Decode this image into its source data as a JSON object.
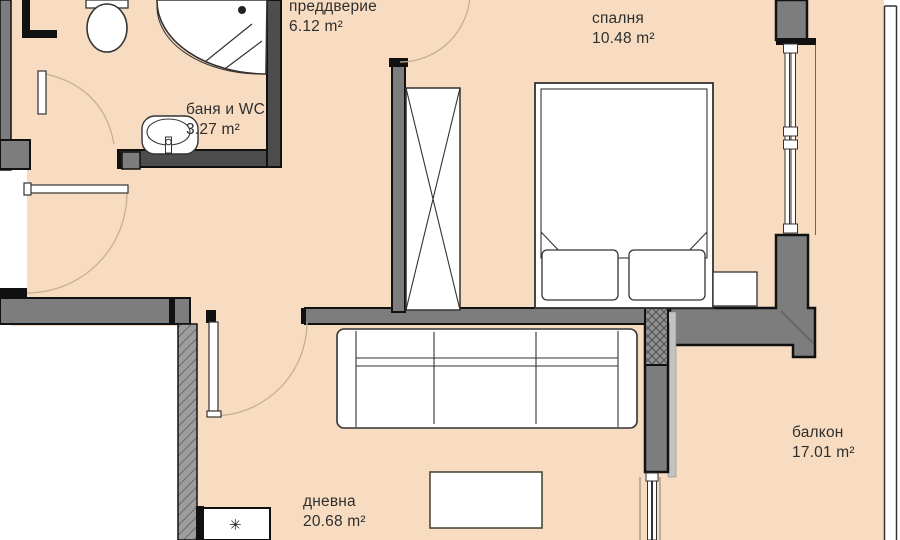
{
  "meta": {
    "type": "apartment-floor-plan",
    "language": "bg"
  },
  "rooms": [
    {
      "id": "hallway",
      "name": "преддверие",
      "area": "6.12 m²"
    },
    {
      "id": "bedroom",
      "name": "спалня",
      "area": "10.48 m²"
    },
    {
      "id": "bathroom",
      "name": "баня и WC",
      "area": "3.27 m²"
    },
    {
      "id": "living-room",
      "name": "дневна",
      "area": "20.68 m²"
    },
    {
      "id": "balcony",
      "name": "балкон",
      "area": "17.01 m²"
    }
  ],
  "fixtures": {
    "appliance_symbol": "✳",
    "items": [
      "shower-cabin",
      "toilet",
      "washbasin",
      "wardrobe",
      "bed",
      "pillows",
      "nightstand",
      "sofa",
      "dining-table",
      "kitchen-appliance"
    ],
    "doors": [
      "entrance-door",
      "bathroom-door",
      "living-room-door",
      "bedroom-door"
    ],
    "windows": [
      "bedroom-window",
      "balcony-window",
      "balcony-parapet"
    ]
  },
  "colors": {
    "floor": "#f8dcc2",
    "wall": "#7d7d7d",
    "wall_dark": "#4d4d4d",
    "outline": "#111111",
    "hatch": "#9d9d9d",
    "door_arc": "#c8ae92",
    "furniture_line": "#333333",
    "background": "#ffffff"
  }
}
